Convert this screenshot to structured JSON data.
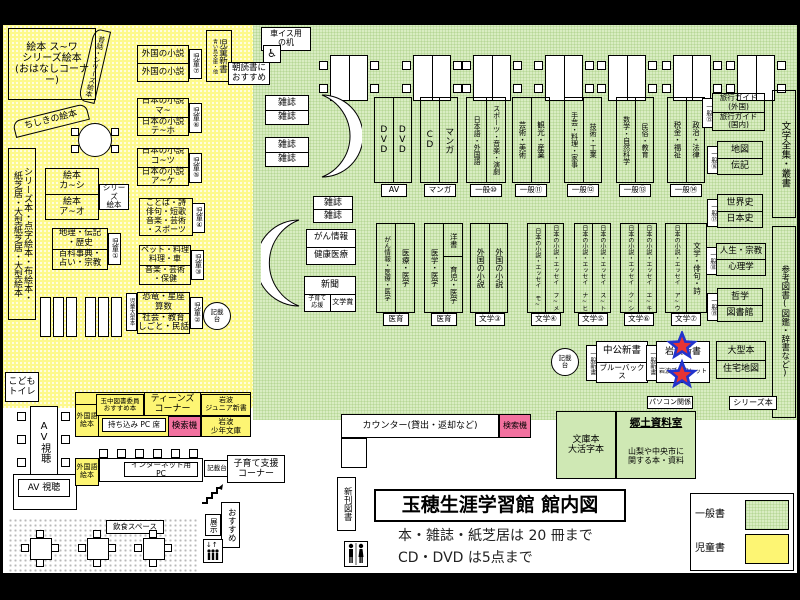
{
  "colors": {
    "general_green": "#d9edc2",
    "children_yellow": "#fdf98c",
    "search_pink": "#f2719f",
    "legend_yellow": "#fdf573",
    "star_red": "#e63333",
    "star_blue": "#2233cc"
  },
  "title": {
    "main": "玉穂生涯学習館 館内図",
    "note1": "本・雑誌・紙芝居は 20 冊まで",
    "note2": "CD・DVD は5点まで"
  },
  "legend": {
    "general": "一般書",
    "children": "児童書"
  },
  "children": {
    "ohanashi": "絵本 ス~ワ\nシリーズ絵本\n(おはなしコーナー)",
    "mukashi": "昔話・シリーズ絵本",
    "chishiki": "ちしきの絵本",
    "left_strip": "シリーズ本・点字絵本・布絵本・\n紙芝居・大型紙芝居・大型絵本",
    "ehon_ka": "絵本\nカ~シ",
    "ehon_a": "絵本\nア~オ",
    "series_tab": "シリーズ\n絵本",
    "chiri": "地理・伝記\n・歴史",
    "hyakka": "百科事典・\n占い・宗教",
    "jidou_ogata": "児童大型本",
    "gaikoku": "外国の小説",
    "jidou_shinsho": "児童新書",
    "aoitori": "青い鳥文庫・他",
    "asadoku": "朝読書に\nおすすめ",
    "nihon_ma": "日本の小説\nマ~",
    "nihon_te": "日本の小説\nテ~ホ",
    "nihon_ko": "日本の小説\nコ~ツ",
    "nihon_ake": "日本の小説\nア~ケ",
    "kotoba": "ことば・詩\n俳句・短歌\n音楽・芸術\n・スポーツ",
    "pet": "ペット・料理\n料理・車",
    "ongaku": "音楽・芸術\n・保健",
    "kyoryu": "恐竜・星座\n算数",
    "shakai": "社会・教育\nしごと・民話",
    "tabs": {
      "t1": "児童①",
      "t2": "児童②",
      "t3": "児童③",
      "t4": "児童④",
      "t5": "児童⑤",
      "t6": "児童⑥",
      "t7": "児童⑦"
    },
    "toilet": "こども\nトイレ"
  },
  "general": {
    "kurumaisu": "車イス用\nの机",
    "zasshi": "雑誌",
    "gan": "がん情報",
    "kenko": "健康医療",
    "shinbun": "新聞",
    "kosodate_ouen": "子育て\n応援",
    "bungakusho": "文学賞",
    "kisaidai": "記載\n台",
    "shelves_top": [
      {
        "left": "DVD",
        "right": "DVD",
        "tag": "AV"
      },
      {
        "left": "CD",
        "right": "マンガ",
        "tag": "マンガ"
      },
      {
        "left": "日本語・外国語",
        "right": "スポーツ・音楽・演劇",
        "tag": "一般⑩"
      },
      {
        "left": "芸術・美術",
        "right": "観光・産業",
        "tag": "一般⑪"
      },
      {
        "left": "手芸・料理・家事",
        "right": "技術・工業",
        "tag": "一般⑫"
      },
      {
        "left": "数学・自然科学",
        "right": "民俗・教育",
        "tag": "一般⑬"
      },
      {
        "left": "税金・福祉",
        "right": "政治・法律",
        "tag": "一般⑭"
      }
    ],
    "shelves_mid": [
      {
        "left": "がん情報・医療・医学",
        "right": "医療・医学",
        "tag": "医育"
      },
      {
        "left": "医学・医学",
        "right_top": "洋書",
        "right_bottom": "育児・医学",
        "tag": "医育"
      },
      {
        "left": "外国の小説",
        "right": "外国の小説",
        "tag": "文学③"
      },
      {
        "left": "日本の小説・エッセイ モ~",
        "right": "日本の小説・エッセイ フ~メ",
        "tag": "文学④"
      },
      {
        "left": "日本の小説・エッセイ ナ~ヒ",
        "right": "日本の小説・エッセイ ス~ト",
        "tag": "文学⑤"
      },
      {
        "left": "日本の小説・エッセイ ク~シ",
        "right": "日本の小説・エッセイ エ~キ",
        "tag": "文学⑥"
      },
      {
        "left": "日本の小説・エッセイ ア~ウ",
        "right": "文学・俳句・詩",
        "tag": "文学⑦"
      }
    ],
    "right_col": [
      {
        "top": "旅行ガイド\n(外国)",
        "bottom": "旅行ガイド\n(国内)",
        "tab": "一般⑮"
      },
      {
        "top": "地図",
        "bottom": "伝記",
        "tab": "一般⑯"
      },
      {
        "top": "世界史",
        "bottom": "日本史",
        "tab": "一般⑰"
      },
      {
        "top": "人生・宗教",
        "bottom": "心理学",
        "tab": "一般⑱"
      },
      {
        "top": "哲学",
        "bottom": "図書館",
        "tab": "一般⑲"
      },
      {
        "top": "大型本",
        "bottom": "住宅地図"
      }
    ],
    "chuko": "中公新書",
    "bluebacks": "ブルーバックス",
    "iwanami_shinsho": "岩波新書",
    "iwanami_booklet": "岩波ブックレット",
    "shinsho_tab": "一般新書",
    "zenshu": "文学全集・叢書",
    "sanko": "参考図書(図鑑・辞書など)",
    "pasokon": "パソコン関係",
    "series_hon": "シリーズ本"
  },
  "bottom": {
    "counter": "カウンター(貸出・返却など)",
    "kensakuki": "検索機",
    "shinkan": "新刊図書",
    "bunko": "文庫本\n大活字本",
    "kyodo_title": "郷土資料室",
    "kyodo_desc": "山梨や中央市に\n関する本・資料",
    "av": "AV視聴",
    "av2": "AV 視聴",
    "gaikokugo": "外国語\n絵本",
    "tamachu": "玉中図書委員\nおすすめ本",
    "teens": "ティーンズ\nコーナー",
    "iwanami_jr": "岩波\nジュニア新書",
    "mochikomi": "持ち込み PC 席",
    "iwanami_shonen": "岩波\n少年文庫",
    "internet": "インターネット用 PC",
    "kisaidai": "記載台",
    "kosodate": "子育て支援\nコーナー",
    "osusume": "おすすめ",
    "tenji": "展示",
    "inshoku": "飲食スペース"
  }
}
